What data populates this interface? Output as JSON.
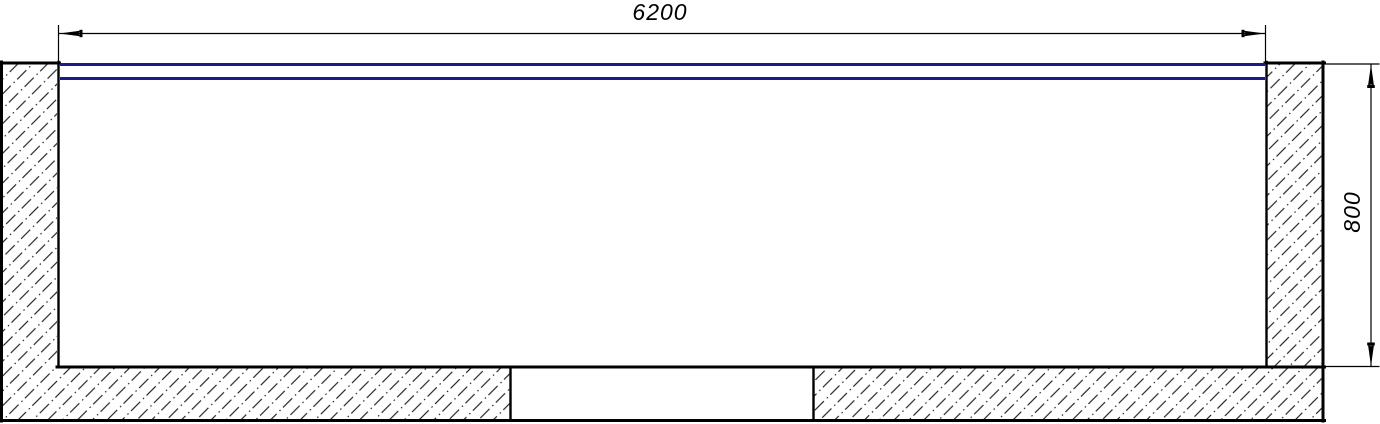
{
  "drawing": {
    "type": "technical-section-drawing",
    "dimension_width": {
      "label": "6200"
    },
    "dimension_height": {
      "label": "800"
    },
    "colors": {
      "line": "#000000",
      "water_line": "#1a1a8c",
      "background": "#ffffff"
    }
  }
}
